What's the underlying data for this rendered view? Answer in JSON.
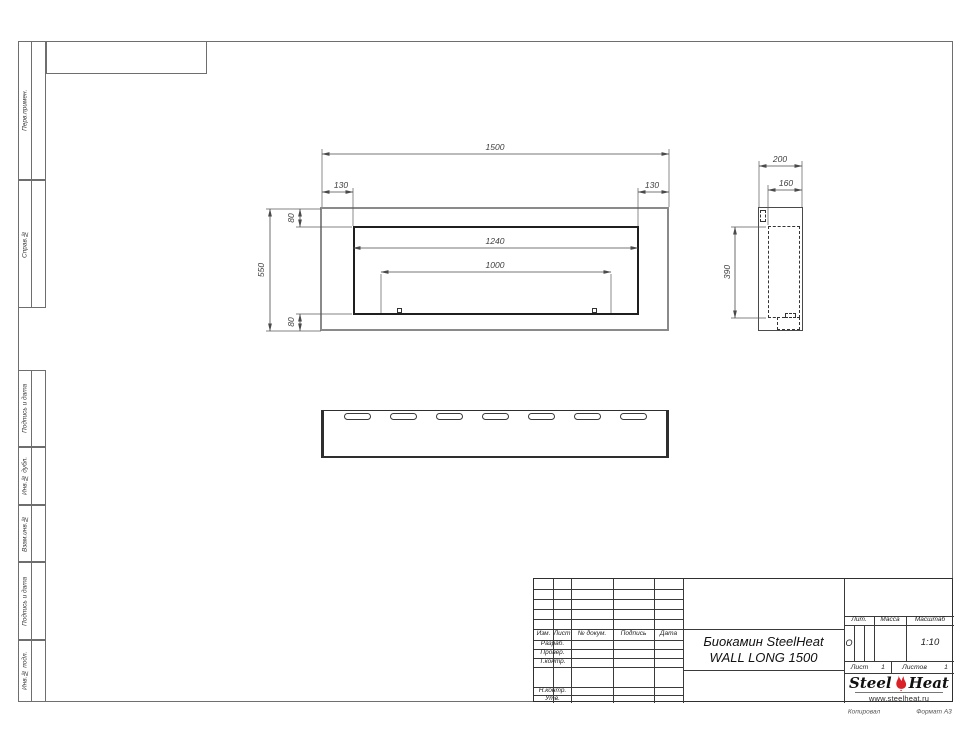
{
  "sidebar": {
    "items": [
      "Перв.примен.",
      "Справ.№",
      "Подпись и дата",
      "Инв.№ дубл.",
      "Взам.инв.№",
      "Подпись и дата",
      "Инв.№ подл."
    ]
  },
  "dims": {
    "front": {
      "width": "1500",
      "margin_left": "130",
      "margin_right": "130",
      "top": "80",
      "height": "550",
      "opening_width": "1240",
      "burner_width": "1000",
      "bottom": "80"
    },
    "side": {
      "depth": "200",
      "inner_depth": "160",
      "opening_height": "390"
    }
  },
  "title_block": {
    "revision_header": [
      "Изм.",
      "Лист",
      "№ докум.",
      "Подпись",
      "Дата"
    ],
    "role_rows": [
      "Разраб.",
      "Провер.",
      "Т.контр.",
      "Н.контр.",
      "Утв."
    ],
    "title_line1": "Биокамин SteelHeat",
    "title_line2": "WALL LONG 1500",
    "lit_label": "Лит.",
    "lit_value": "О",
    "mass_label": "Масса",
    "scale_label": "Масштаб",
    "scale_value": "1:10",
    "sheet_label": "Лист",
    "sheet_number": "1",
    "sheets_label": "Листов",
    "sheets_total": "1",
    "logo": {
      "brand_left": "Steel",
      "brand_right": "Heat",
      "website": "www.steelheat.ru",
      "flame_color": "#d92127"
    }
  },
  "footer": {
    "copied_by": "Копировал",
    "format": "Формат А3"
  }
}
